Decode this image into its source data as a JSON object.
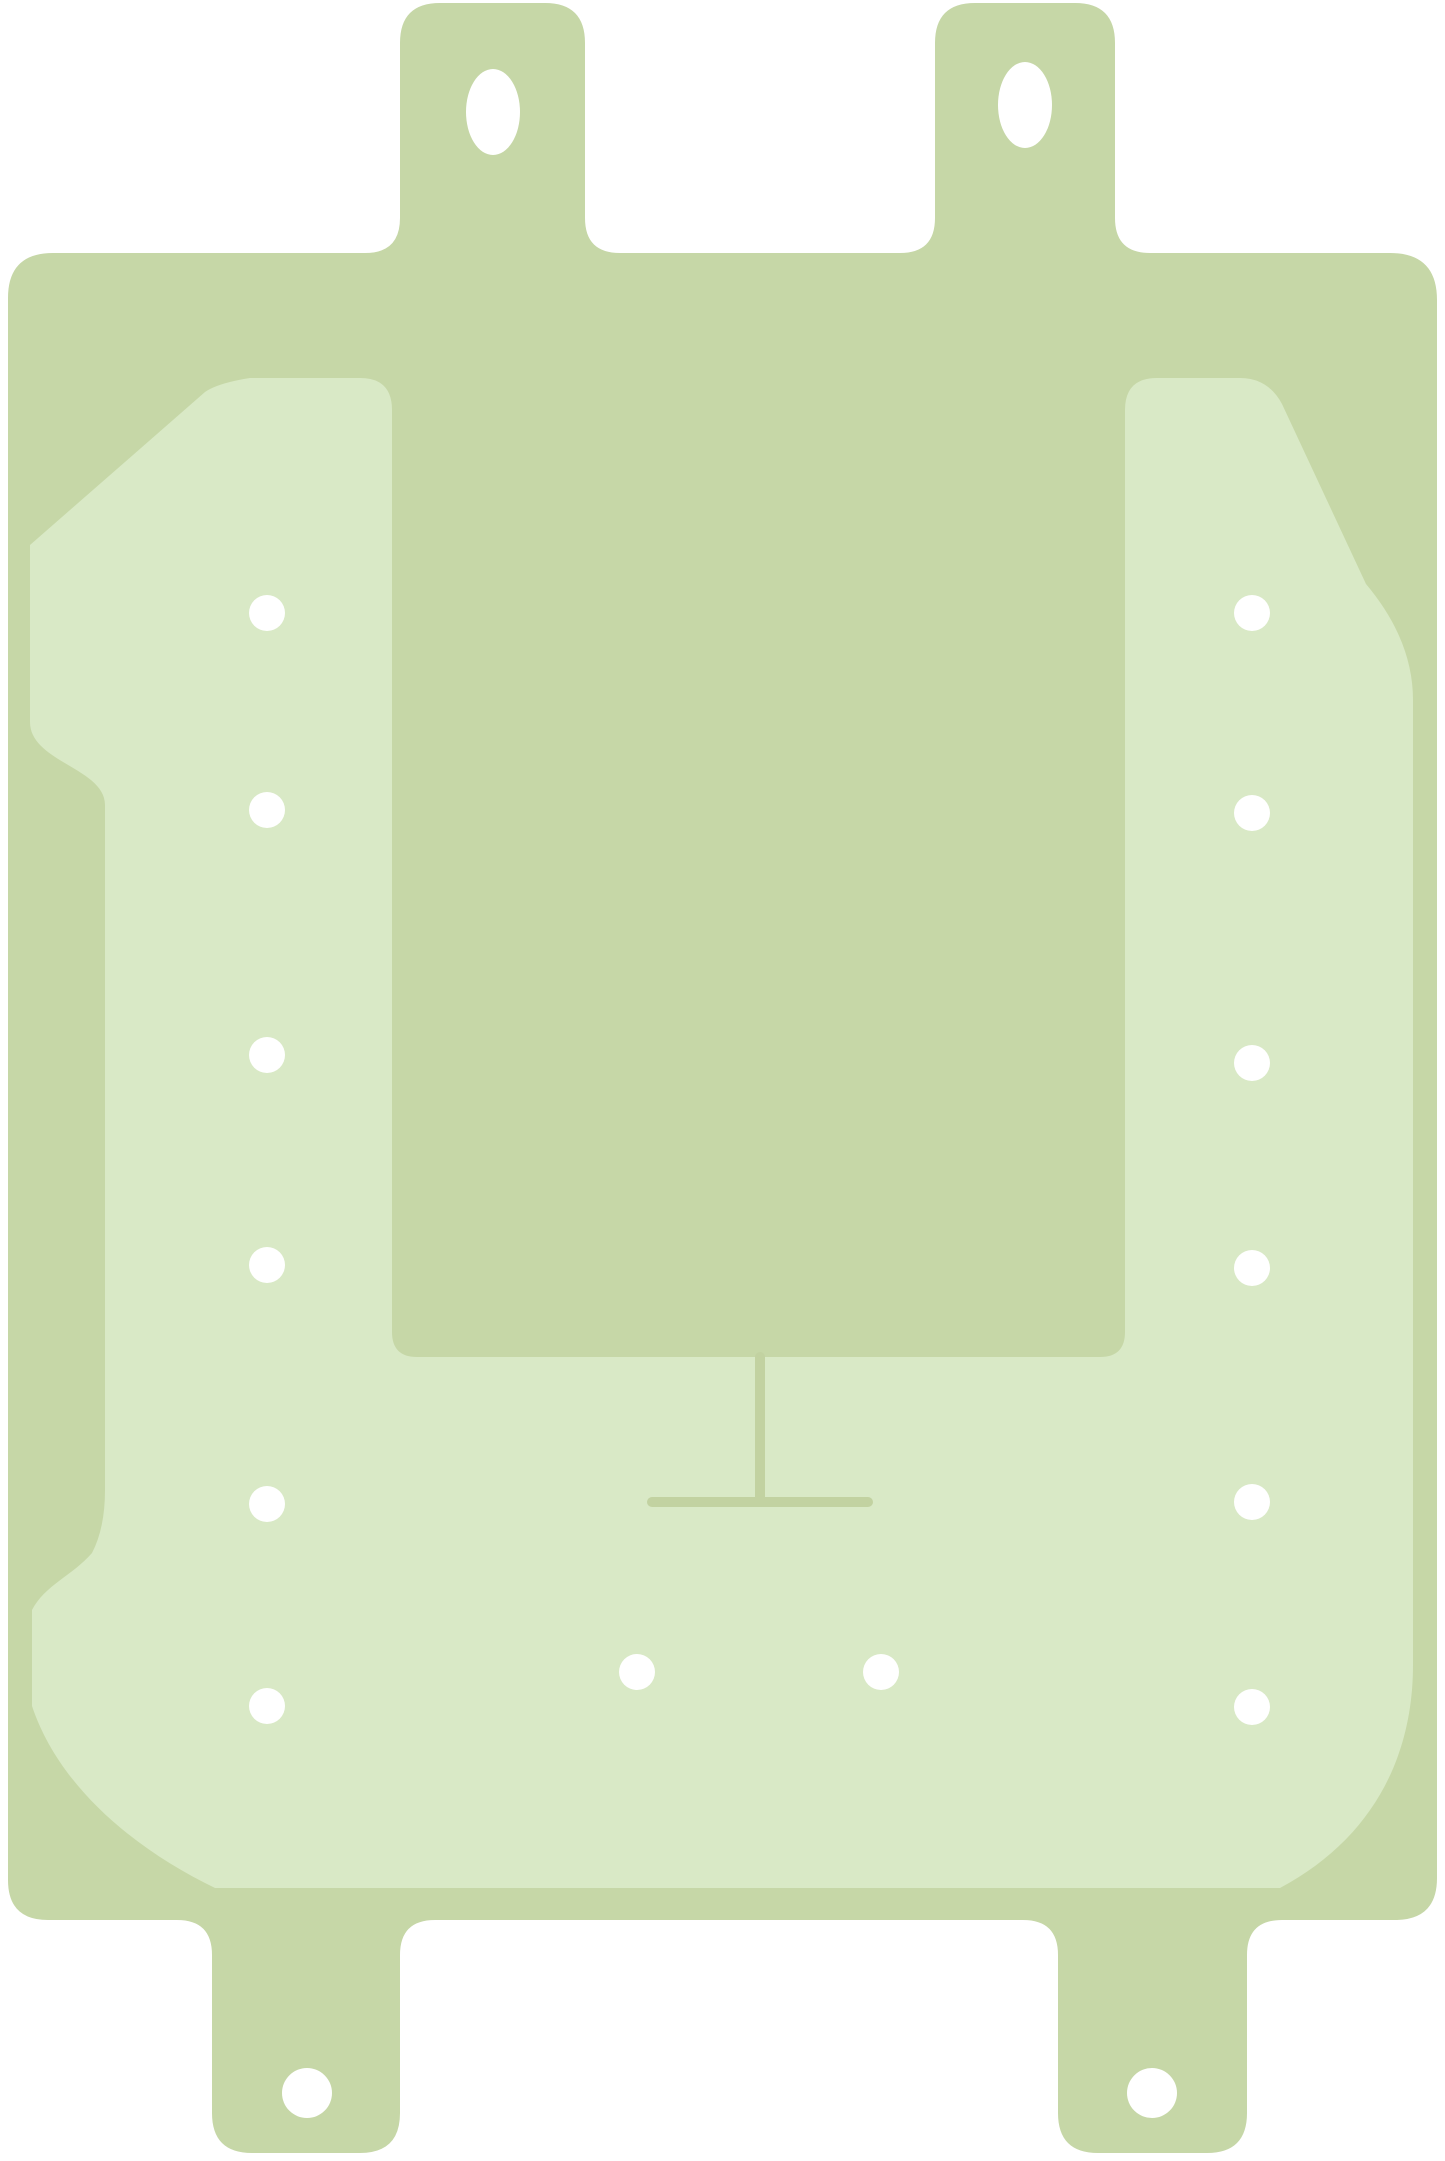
{
  "image": {
    "description": "Flat illustration of a light-green adhesive gasket sticker template with two top pull tabs, two bottom pull tabs, an inner lighter adhesive pad shaped like a U around a central rectangular cutout, punch holes along left and right columns, two bottom punch holes, slot holes in each tab, and a T-shaped score line below the central rectangle.",
    "width": 1445,
    "height": 2161
  },
  "colors": {
    "background": "#ffffff",
    "body": "#c6d7a7",
    "pad": "#d9e9c6",
    "score_line": "#c2d2a1",
    "hole": "#ffffff"
  },
  "holes": {
    "left_column": {
      "cx": 267,
      "r": 18,
      "cy_list": [
        613,
        810,
        1055,
        1265,
        1504,
        1706
      ]
    },
    "right_column": {
      "cx": 1252,
      "r": 18,
      "cy_list": [
        613,
        813,
        1063,
        1268,
        1502,
        1707
      ]
    },
    "bottom_row": {
      "r": 18,
      "centers": [
        [
          637,
          1672
        ],
        [
          881,
          1672
        ]
      ]
    },
    "top_tab_slots": {
      "rx": 27,
      "ry": 43,
      "centers": [
        [
          493,
          112
        ],
        [
          1025,
          105
        ]
      ]
    },
    "bottom_tab_holes": {
      "r": 25,
      "centers": [
        [
          307,
          2093
        ],
        [
          1152,
          2093
        ]
      ]
    }
  },
  "score_marks": {
    "stroke_width": 10,
    "tee_vertical": {
      "x": 760,
      "y1": 1357,
      "y2": 1500
    },
    "tee_horizontal": {
      "y": 1502,
      "x1": 652,
      "x2": 868
    }
  }
}
